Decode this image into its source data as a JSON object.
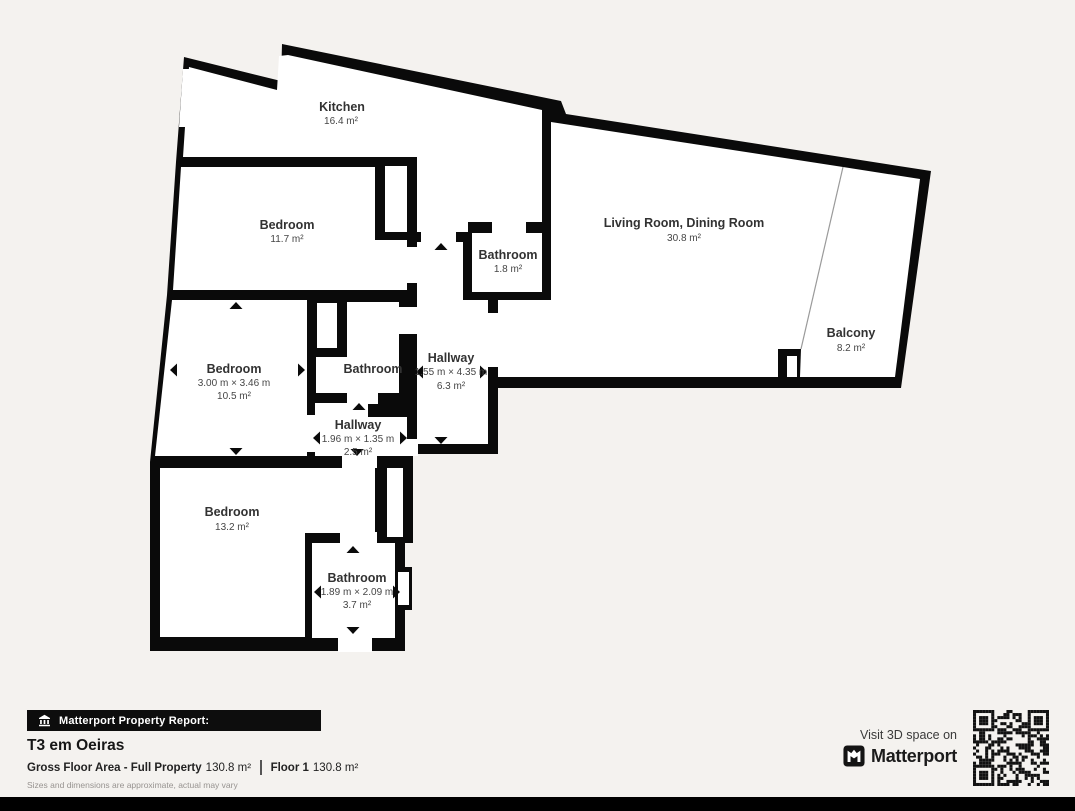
{
  "colors": {
    "wall": "#0a0a0a",
    "background": "#f4f2ef",
    "floor": "#ffffff",
    "label_text": "#323232"
  },
  "icons": {
    "report_badge": "building-icon",
    "brand_mark": "matterport-m-icon",
    "qr": "qr-code"
  },
  "rooms": {
    "kitchen": {
      "name": "Kitchen",
      "area": "16.4 m²"
    },
    "bedroom_top": {
      "name": "Bedroom",
      "area": "11.7 m²"
    },
    "living_dining": {
      "name": "Living Room, Dining Room",
      "area": "30.8 m²"
    },
    "bathroom_service": {
      "name": "Bathroom",
      "area": "1.8 m²"
    },
    "balcony": {
      "name": "Balcony",
      "area": "8.2 m²"
    },
    "bedroom_middle": {
      "name": "Bedroom",
      "dims": "3.00 m × 3.46 m",
      "area": "10.5 m²"
    },
    "bathroom_middle": {
      "name": "Bathroom"
    },
    "hallway_main": {
      "name": "Hallway",
      "dims": "1.55 m × 4.35 m",
      "area": "6.3 m²"
    },
    "hallway_small": {
      "name": "Hallway",
      "dims": "1.96 m × 1.35 m",
      "area": "2.5 m²"
    },
    "bedroom_bottom": {
      "name": "Bedroom",
      "area": "13.2 m²"
    },
    "bathroom_bottom": {
      "name": "Bathroom",
      "dims": "1.89 m × 2.09 m",
      "area": "3.7 m²"
    }
  },
  "report": {
    "badge_label": "Matterport Property Report:",
    "title": "T3 em Oeiras",
    "gfa_label": "Gross Floor Area - Full Property",
    "gfa_value": "130.8 m²",
    "floor_label": "Floor 1",
    "floor_value": "130.8 m²",
    "disclaimer": "Sizes and dimensions are approximate, actual may vary"
  },
  "cta": {
    "visit_label": "Visit 3D space on",
    "brand": "Matterport"
  }
}
